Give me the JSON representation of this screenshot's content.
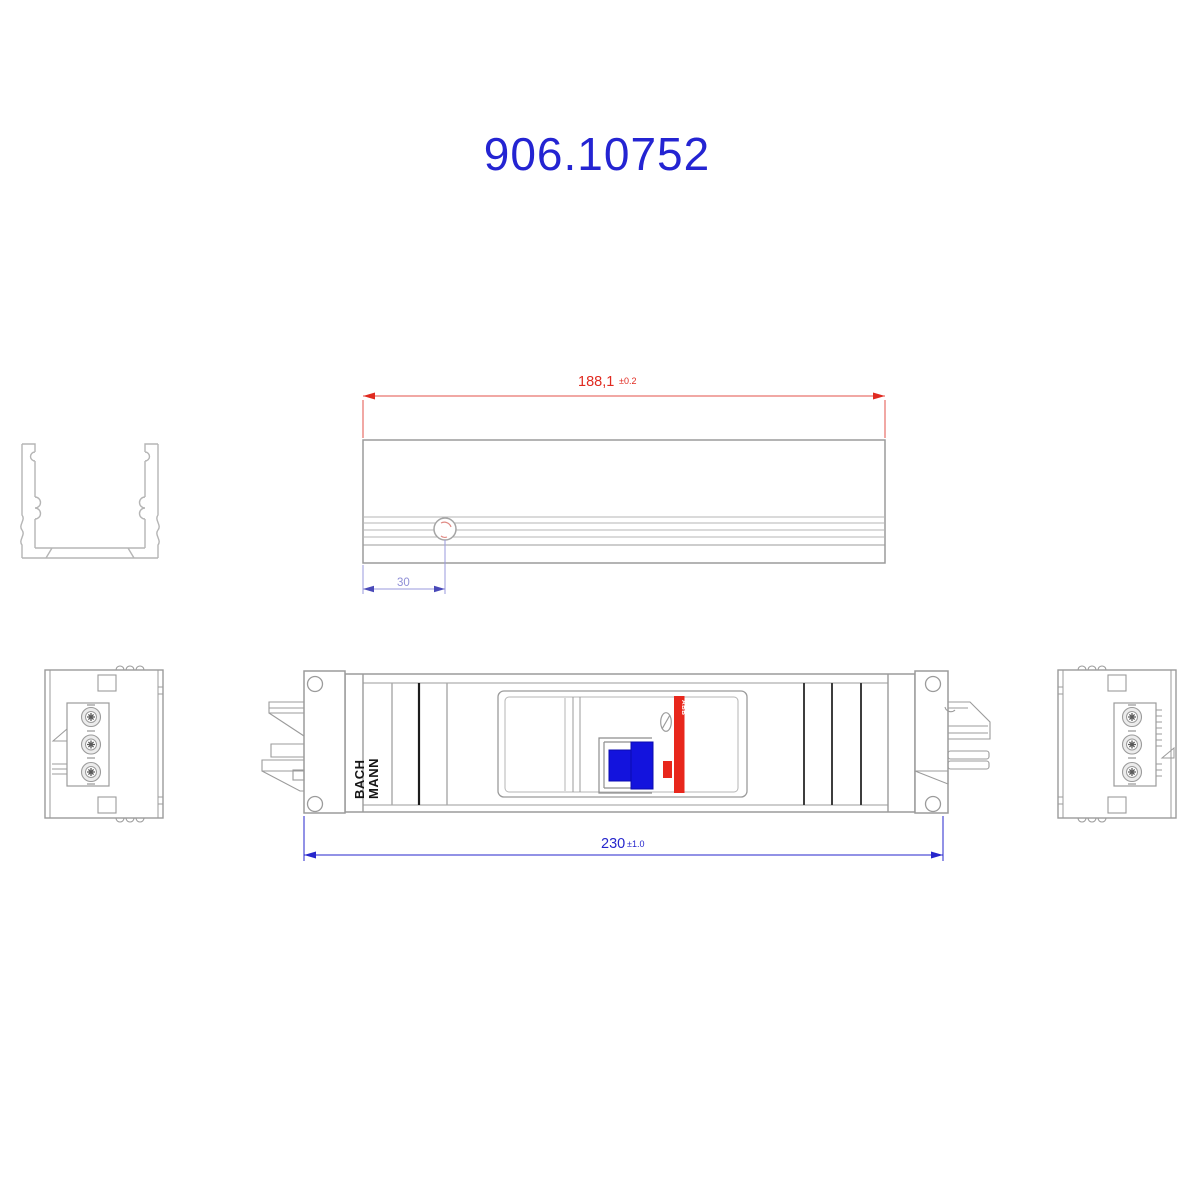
{
  "title": {
    "text": "906.10752"
  },
  "top_view": {
    "dim_length": {
      "value": "188,1",
      "tolerance": "±0.2"
    },
    "dim_hole_offset": {
      "value": "30"
    }
  },
  "front_view": {
    "brand_line1": "BACH",
    "brand_line2": "MANN",
    "breaker_label": "ABB",
    "dim_overall": {
      "value": "230",
      "tolerance": "±1.0"
    }
  },
  "colors": {
    "title_blue": "#2424d2",
    "dimension_red_text": "#e02a20",
    "dimension_red_line": "#e35048",
    "dimension_blue": "#2626cc",
    "dimension_light_blue_line": "#9a9ade",
    "dimension_light_blue_text": "#8f8fd6",
    "outline_gray": "#9b9b9b",
    "outline_light": "#b5b5b5",
    "accent_black": "#1c1c1c",
    "connector_blue": "#1313dd",
    "breaker_red": "#e8271c",
    "background": "#ffffff"
  }
}
